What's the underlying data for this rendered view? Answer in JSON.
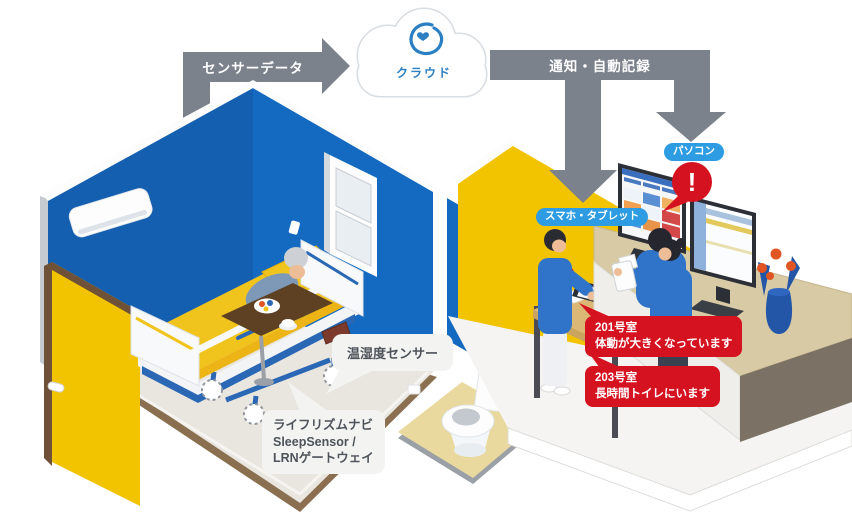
{
  "diagram": {
    "cloud_label": "クラウド",
    "arrow_sensor_data": "センサーデータ",
    "arrow_notify": "通知・自動記録",
    "badge_pc": "パソコン",
    "badge_smartphone_tablet": "スマホ・タブレット",
    "exclamation": "!",
    "callout_temp_humidity": "温湿度センサー",
    "callout_device_line1": "ライフリズムナビ",
    "callout_device_line2": "SleepSensor /",
    "callout_device_line3": "LRNゲートウェイ",
    "alerts": [
      {
        "room": "201号室",
        "message": "体動が大きくなっています"
      },
      {
        "room": "203号室",
        "message": "長時間トイレにいます"
      }
    ],
    "colors": {
      "wall_blue": "#1565b8",
      "accent_yellow": "#f2c400",
      "arrow_gray": "#7b828c",
      "alert_red": "#d5121f",
      "badge_blue": "#2d9ce2",
      "logo_blue": "#2b7fc3"
    }
  }
}
